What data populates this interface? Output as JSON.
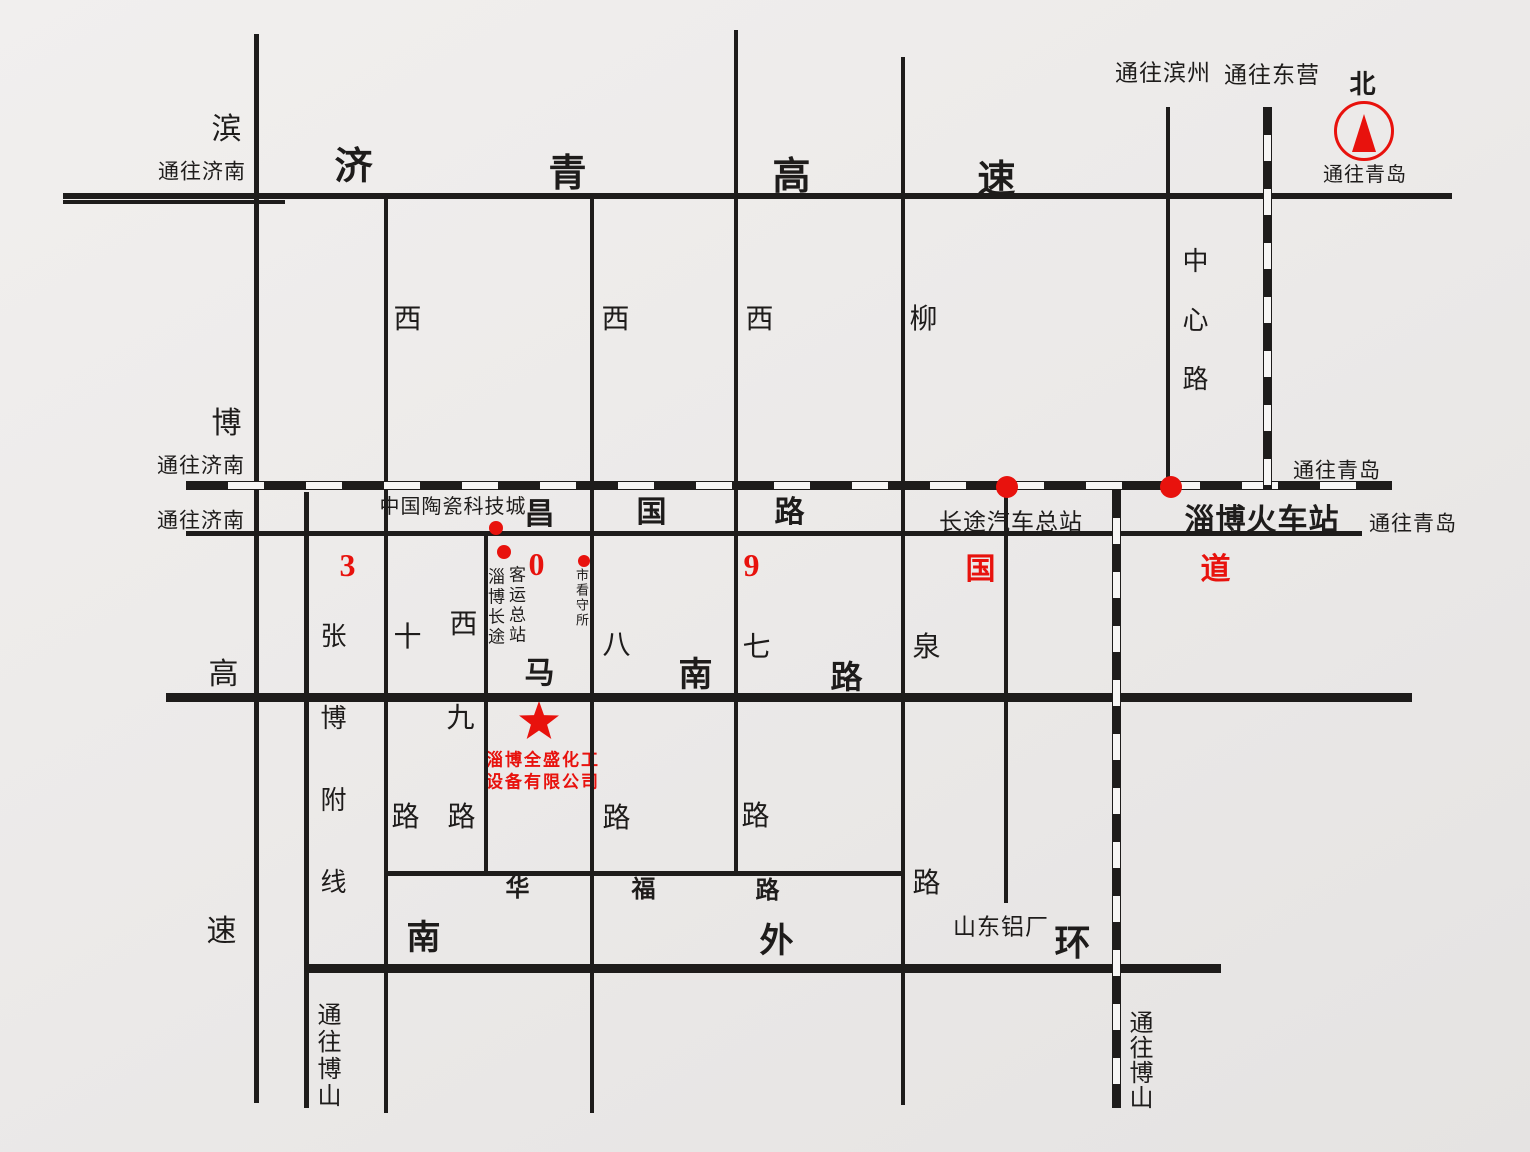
{
  "palette": {
    "ink": "#1e1c1b",
    "red": "#e8120d",
    "paper": "#eceae9"
  },
  "company": {
    "line1": "淄博全盛化工",
    "line2": "设备有限公司",
    "star_x": 539,
    "star_y": 722,
    "line1_x": 543,
    "line1_y": 758,
    "line2_x": 543,
    "line2_y": 780
  },
  "compass": {
    "north": "北",
    "caption": "通往青岛",
    "cx": 1364,
    "cy": 131,
    "r": 27,
    "north_x": 1363,
    "north_y": 85,
    "caption_x": 1365,
    "caption_y": 175
  },
  "roads": {
    "solid": [
      {
        "id": "jiqing-expressway",
        "name": "济青高速",
        "x": 63,
        "y": 193,
        "w": 1389,
        "h": 6
      },
      {
        "id": "jiqing-expressway-jog",
        "name": "济青高速",
        "x": 63,
        "y": 200,
        "w": 222,
        "h": 4
      },
      {
        "id": "changguo-road",
        "name": "昌国路(309国道)",
        "x": 186,
        "y": 531,
        "w": 1176,
        "h": 5
      },
      {
        "id": "manan-road",
        "name": "马南路",
        "x": 166,
        "y": 693,
        "w": 1246,
        "h": 9
      },
      {
        "id": "huafu-road",
        "name": "华福路",
        "x": 387,
        "y": 871,
        "w": 516,
        "h": 5
      },
      {
        "id": "south-outer-ring",
        "name": "南外环",
        "x": 307,
        "y": 964,
        "w": 914,
        "h": 9
      },
      {
        "id": "binbo-expressway",
        "name": "滨博高速",
        "x": 254,
        "y": 34,
        "w": 5,
        "h": 1069
      },
      {
        "id": "zhangbo-branch-line",
        "name": "张博附线",
        "x": 304,
        "y": 492,
        "w": 5,
        "h": 616
      },
      {
        "id": "xishi-road",
        "name": "西十路",
        "x": 384,
        "y": 196,
        "w": 4,
        "h": 917
      },
      {
        "id": "xijiu-road",
        "name": "西九路",
        "x": 484,
        "y": 535,
        "w": 4,
        "h": 338
      },
      {
        "id": "xiba-road",
        "name": "西八路",
        "x": 590,
        "y": 196,
        "w": 4,
        "h": 917
      },
      {
        "id": "xiqi-road",
        "name": "西七路",
        "x": 734,
        "y": 30,
        "w": 4,
        "h": 843
      },
      {
        "id": "liuquan-road",
        "name": "柳泉路",
        "x": 901,
        "y": 57,
        "w": 4,
        "h": 1048
      },
      {
        "id": "bus-station-road",
        "name": "",
        "x": 1004,
        "y": 490,
        "w": 4,
        "h": 413
      },
      {
        "id": "zhongxin-road",
        "name": "中心路",
        "x": 1166,
        "y": 107,
        "w": 4,
        "h": 383
      }
    ],
    "railway": [
      {
        "id": "railway-jinan-qingdao",
        "dir": "h",
        "x": 186,
        "y": 481,
        "w": 1206,
        "h": 9
      },
      {
        "id": "railway-to-dongying",
        "dir": "v",
        "x": 1263,
        "y": 107,
        "w": 9,
        "h": 383
      },
      {
        "id": "railway-to-boshan",
        "dir": "v",
        "x": 1112,
        "y": 490,
        "w": 9,
        "h": 618
      }
    ]
  },
  "station_dots": [
    {
      "name": "dot-bus-terminal",
      "x": 1007,
      "y": 487,
      "d": 22
    },
    {
      "name": "dot-train-station",
      "x": 1171,
      "y": 487,
      "d": 22
    },
    {
      "name": "dot-ceramics-city",
      "x": 496,
      "y": 528,
      "d": 14
    },
    {
      "name": "dot-coach-terminal",
      "x": 504,
      "y": 552,
      "d": 14
    },
    {
      "name": "dot-detention-house",
      "x": 584,
      "y": 561,
      "d": 12
    }
  ],
  "labels": [
    {
      "name": "binbo-bin",
      "text": "滨",
      "x": 227,
      "y": 130,
      "size": 30
    },
    {
      "name": "binbo-bo",
      "text": "博",
      "x": 227,
      "y": 424,
      "size": 30
    },
    {
      "name": "binbo-gao",
      "text": "高",
      "x": 224,
      "y": 675,
      "size": 30
    },
    {
      "name": "binbo-su",
      "text": "速",
      "x": 222,
      "y": 932,
      "size": 30
    },
    {
      "name": "to-jinan-top",
      "text": "通往济南",
      "x": 202,
      "y": 172,
      "size": 21
    },
    {
      "name": "to-jinan-railway",
      "text": "通往济南",
      "x": 201,
      "y": 466,
      "size": 21
    },
    {
      "name": "to-jinan-changguo",
      "text": "通往济南",
      "x": 201,
      "y": 521,
      "size": 21
    },
    {
      "name": "jiqing-ji",
      "text": "济",
      "x": 354,
      "y": 167,
      "size": 38,
      "bold": true
    },
    {
      "name": "jiqing-qing",
      "text": "青",
      "x": 568,
      "y": 174,
      "size": 38,
      "bold": true
    },
    {
      "name": "jiqing-gao",
      "text": "高",
      "x": 792,
      "y": 177,
      "size": 38,
      "bold": true
    },
    {
      "name": "jiqing-su",
      "text": "速",
      "x": 997,
      "y": 180,
      "size": 38,
      "bold": true
    },
    {
      "name": "to-binzhou",
      "text": "通往滨州",
      "x": 1163,
      "y": 73,
      "size": 23
    },
    {
      "name": "to-dongying",
      "text": "通往东营",
      "x": 1272,
      "y": 75,
      "size": 23
    },
    {
      "name": "xishi-xi-top",
      "text": "西",
      "x": 408,
      "y": 320,
      "size": 28
    },
    {
      "name": "xiba-xi-top",
      "text": "西",
      "x": 616,
      "y": 320,
      "size": 28
    },
    {
      "name": "xiqi-xi-top",
      "text": "西",
      "x": 760,
      "y": 320,
      "size": 28
    },
    {
      "name": "liuquan-liu",
      "text": "柳",
      "x": 924,
      "y": 320,
      "size": 28
    },
    {
      "name": "zhongxin-road-label",
      "text": "中心路",
      "x": 1196,
      "y": 262,
      "size": 26,
      "vertical": true,
      "step": 59
    },
    {
      "name": "to-qingdao-railway",
      "text": "通往青岛",
      "x": 1337,
      "y": 471,
      "size": 21
    },
    {
      "name": "to-qingdao-changguo",
      "text": "通往青岛",
      "x": 1413,
      "y": 524,
      "size": 21
    },
    {
      "name": "ceramics-city-label",
      "text": "中国陶瓷科技城",
      "x": 453,
      "y": 507,
      "size": 20
    },
    {
      "name": "changguo-chang",
      "text": "昌",
      "x": 540,
      "y": 515,
      "size": 30,
      "bold": true
    },
    {
      "name": "changguo-guo",
      "text": "国",
      "x": 652,
      "y": 513,
      "size": 30,
      "bold": true
    },
    {
      "name": "changguo-lu",
      "text": "路",
      "x": 790,
      "y": 513,
      "size": 30,
      "bold": true
    },
    {
      "name": "bus-terminal-label",
      "text": "长途汽车总站",
      "x": 1011,
      "y": 522,
      "size": 23
    },
    {
      "name": "train-station-label",
      "text": "淄博火车站",
      "x": 1262,
      "y": 521,
      "size": 30,
      "bold": true
    },
    {
      "name": "g309-digit-3",
      "text": "3",
      "x": 348,
      "y": 565,
      "size": 32,
      "red": true,
      "bold": true
    },
    {
      "name": "g309-digit-0",
      "text": "0",
      "x": 537,
      "y": 564,
      "size": 32,
      "red": true,
      "bold": true
    },
    {
      "name": "g309-digit-9",
      "text": "9",
      "x": 752,
      "y": 565,
      "size": 32,
      "red": true,
      "bold": true
    },
    {
      "name": "g309-guo",
      "text": "国",
      "x": 981,
      "y": 570,
      "size": 30,
      "red": true,
      "bold": true
    },
    {
      "name": "g309-dao",
      "text": "道",
      "x": 1216,
      "y": 570,
      "size": 30,
      "red": true,
      "bold": true
    },
    {
      "name": "coach-terminal-col1",
      "text": "淄博长途",
      "x": 497,
      "y": 577,
      "size": 17,
      "vertical": true,
      "step": 20
    },
    {
      "name": "coach-terminal-col2",
      "text": "客运总站",
      "x": 518,
      "y": 575,
      "size": 17,
      "vertical": true,
      "step": 20
    },
    {
      "name": "detention-label",
      "text": "市看守所",
      "x": 583,
      "y": 575,
      "size": 13,
      "vertical": true,
      "step": 15
    },
    {
      "name": "zhangbo-branch-label",
      "text": "张博附线",
      "x": 334,
      "y": 637,
      "size": 26,
      "vertical": true,
      "step": 82
    },
    {
      "name": "xishi-shi",
      "text": "十",
      "x": 408,
      "y": 638,
      "size": 28
    },
    {
      "name": "xishi-lu",
      "text": "路",
      "x": 406,
      "y": 818,
      "size": 28
    },
    {
      "name": "xijiu-xi",
      "text": "西",
      "x": 464,
      "y": 625,
      "size": 28
    },
    {
      "name": "xijiu-jiu",
      "text": "九",
      "x": 461,
      "y": 719,
      "size": 28
    },
    {
      "name": "xijiu-lu",
      "text": "路",
      "x": 462,
      "y": 818,
      "size": 28
    },
    {
      "name": "xiba-ba",
      "text": "八",
      "x": 617,
      "y": 646,
      "size": 28
    },
    {
      "name": "xiba-lu",
      "text": "路",
      "x": 617,
      "y": 819,
      "size": 28
    },
    {
      "name": "xiqi-qi",
      "text": "七",
      "x": 757,
      "y": 648,
      "size": 28
    },
    {
      "name": "xiqi-lu",
      "text": "路",
      "x": 756,
      "y": 817,
      "size": 28
    },
    {
      "name": "liuquan-quan",
      "text": "泉",
      "x": 927,
      "y": 648,
      "size": 28
    },
    {
      "name": "liuquan-lu",
      "text": "路",
      "x": 927,
      "y": 884,
      "size": 28
    },
    {
      "name": "manan-ma",
      "text": "马",
      "x": 540,
      "y": 674,
      "size": 30,
      "bold": true
    },
    {
      "name": "manan-nan",
      "text": "南",
      "x": 696,
      "y": 676,
      "size": 34,
      "bold": true
    },
    {
      "name": "manan-lu",
      "text": "路",
      "x": 847,
      "y": 677,
      "size": 32,
      "bold": true
    },
    {
      "name": "huafu-hua",
      "text": "华",
      "x": 518,
      "y": 889,
      "size": 24,
      "bold": true
    },
    {
      "name": "huafu-fu",
      "text": "福",
      "x": 644,
      "y": 890,
      "size": 24,
      "bold": true
    },
    {
      "name": "huafu-lu",
      "text": "路",
      "x": 768,
      "y": 891,
      "size": 24,
      "bold": true
    },
    {
      "name": "ring-nan",
      "text": "南",
      "x": 424,
      "y": 939,
      "size": 34,
      "bold": true
    },
    {
      "name": "ring-wai",
      "text": "外",
      "x": 777,
      "y": 942,
      "size": 34,
      "bold": true
    },
    {
      "name": "ring-huan",
      "text": "环",
      "x": 1073,
      "y": 943,
      "size": 36,
      "bold": true
    },
    {
      "name": "aluminum-plant-label",
      "text": "山东铝厂",
      "x": 1001,
      "y": 927,
      "size": 23
    },
    {
      "name": "to-boshan-left",
      "text": "通往博山",
      "x": 330,
      "y": 1016,
      "size": 24,
      "vertical": true,
      "step": 27
    },
    {
      "name": "to-boshan-right",
      "text": "通往博山",
      "x": 1142,
      "y": 1024,
      "size": 24,
      "vertical": true,
      "step": 25
    }
  ]
}
